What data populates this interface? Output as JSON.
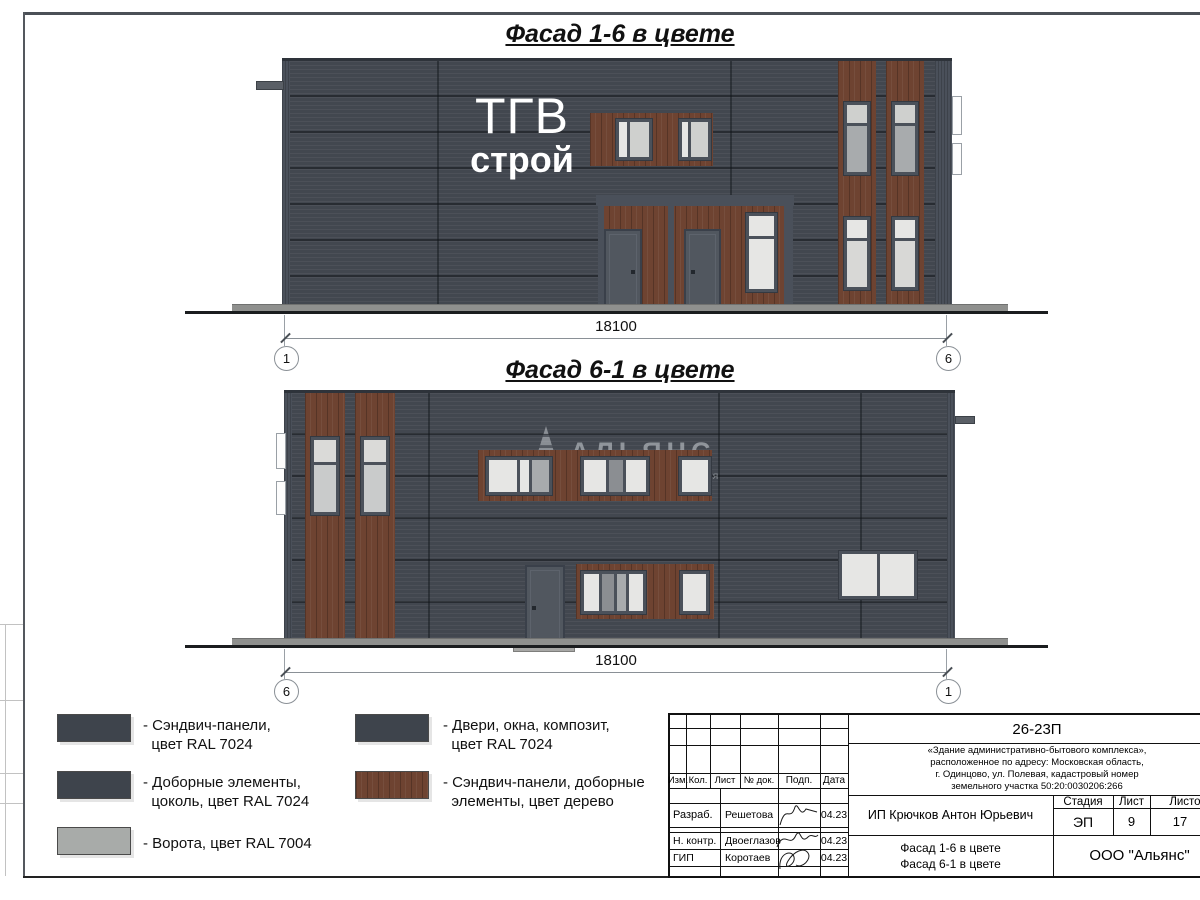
{
  "sheet": {
    "facade1": {
      "title": "Фасад 1-6 в цвете",
      "dimension": "18100",
      "axis_left": "1",
      "axis_right": "6",
      "sign_line1": "ТГВ",
      "sign_line2": "строй"
    },
    "facade2": {
      "title": "Фасад 6-1 в цвете",
      "dimension": "18100",
      "axis_left": "6",
      "axis_right": "1",
      "watermark_name": "АЛЬЯНС",
      "watermark_tagline": "строительная компания"
    },
    "legend": {
      "items": [
        {
          "text": "- Сэндвич-панели,\n  цвет RAL 7024",
          "color": "#3e444c"
        },
        {
          "text": "- Доборные элементы,\n  цоколь, цвет RAL 7024",
          "color": "#3e444c"
        },
        {
          "text": "- Ворота, цвет RAL 7004",
          "color": "#a8aba9"
        },
        {
          "text": "- Двери, окна, композит,\n  цвет RAL 7024",
          "color": "#3e444c"
        },
        {
          "text": "- Сэндвич-панели, доборные\n  элементы, цвет дерево",
          "color": "#6e4331"
        }
      ]
    },
    "titleblock": {
      "code": "26-23П",
      "description": "«Здание административно-бытового комплекса»,\nрасположенное по адресу: Московская область,\nг. Одинцово, ул. Полевая, кадастровый номер\nземельного участка 50:20:0030206:266",
      "columns": [
        "Изм.",
        "Кол.",
        "Лист",
        "№ док.",
        "Подп.",
        "Дата"
      ],
      "rows": [
        {
          "role": "Разраб.",
          "name": "Решетова",
          "date": "04.23"
        },
        {
          "role": "Н. контр.",
          "name": "Двоеглазов",
          "date": "04.23"
        },
        {
          "role": "ГИП",
          "name": "Коротаев",
          "date": "04.23"
        }
      ],
      "client": "ИП Крючков Антон Юрьевич",
      "stage_label": "Стадия",
      "sheet_label": "Лист",
      "sheets_label": "Листов",
      "stage": "ЭП",
      "sheet_no": "9",
      "sheets_total": "17",
      "drawing_title": "Фасад 1-6 в цвете\nФасад 6-1 в цвете",
      "company": "ООО \"Альянс\""
    }
  }
}
